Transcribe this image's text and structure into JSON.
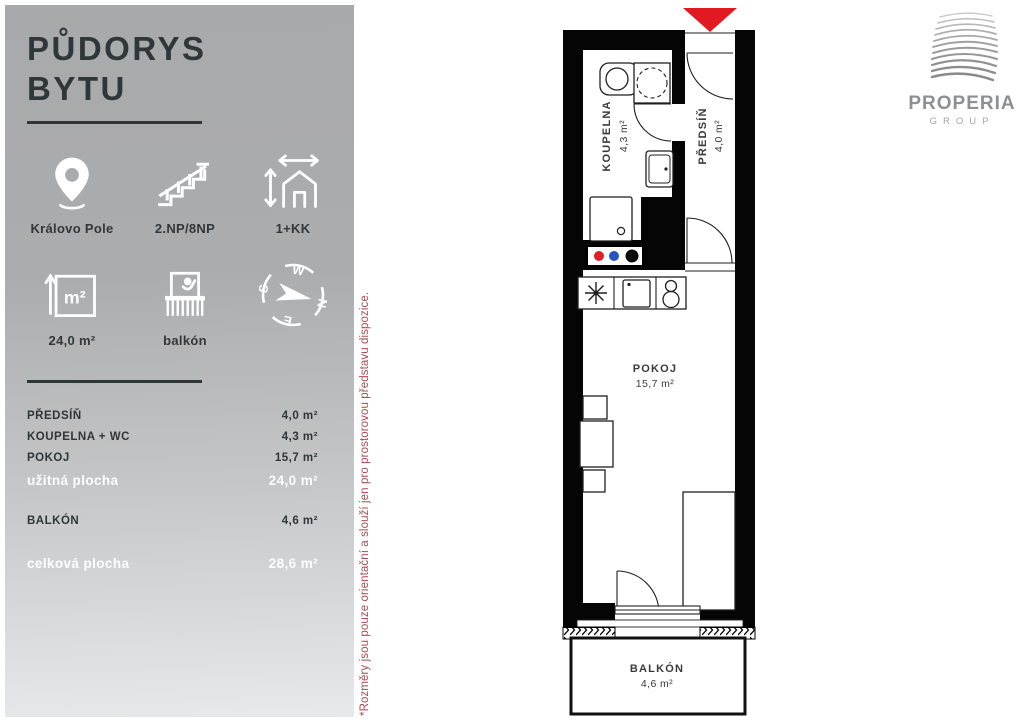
{
  "sidebar": {
    "title_line1": "PŮDORYS",
    "title_line2": "BYTU",
    "features": [
      {
        "icon": "location-pin-icon",
        "label": "Královo Pole"
      },
      {
        "icon": "stairs-icon",
        "label": "2.NP/8NP"
      },
      {
        "icon": "house-layout-icon",
        "label": "1+KK"
      },
      {
        "icon": "area-icon",
        "label": "24,0 m²"
      },
      {
        "icon": "balcony-icon",
        "label": "balkón"
      },
      {
        "icon": "compass-icon",
        "label": ""
      }
    ],
    "m2_icon_text": "m²",
    "compass": {
      "w": "W",
      "s": "S",
      "n": "N",
      "e": "E"
    },
    "rooms_table": [
      {
        "label": "PŘEDSÍŇ",
        "value": "4,0 m²",
        "emphasis": false
      },
      {
        "label": "KOUPELNA + WC",
        "value": "4,3 m²",
        "emphasis": false
      },
      {
        "label": "POKOJ",
        "value": "15,7 m²",
        "emphasis": false
      },
      {
        "label": "užitná plocha",
        "value": "24,0 m²",
        "emphasis": true
      },
      {
        "label": "BALKÓN",
        "value": "4,6 m²",
        "emphasis": false
      },
      {
        "label": "celková plocha",
        "value": "28,6 m²",
        "emphasis": true
      }
    ]
  },
  "disclaimer": "*Rozměry jsou pouze orientační a slouží jen pro prostorovou představu dispozice.",
  "logo": {
    "name": "PROPERIA",
    "subtitle": "GROUP"
  },
  "plan": {
    "rooms": [
      {
        "name": "KOUPELNA",
        "area": "4,3 m²"
      },
      {
        "name": "PŘEDSÍŇ",
        "area": "4,0 m²"
      },
      {
        "name": "POKOJ",
        "area": "15,7 m²"
      },
      {
        "name": "BALKÓN",
        "area": "4,6 m²"
      }
    ]
  },
  "colors": {
    "entrance_arrow": "#e01a20",
    "disclaimer_red": "#a84b53",
    "wall_black": "#050505",
    "sidebar_gray_top": "#a8a9ab",
    "sidebar_gray_bottom": "#e8e9ea",
    "hookup_red": "#df2026",
    "hookup_blue": "#2753c5"
  }
}
